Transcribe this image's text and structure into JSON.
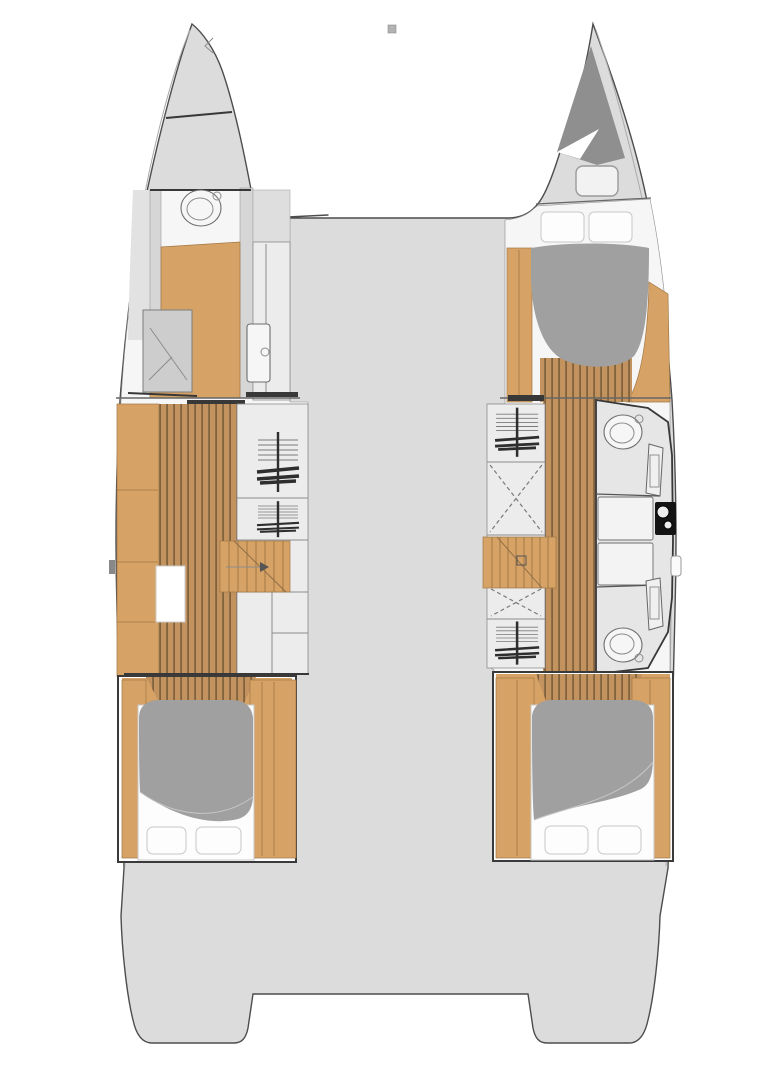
{
  "meta": {
    "diagram_type": "catamaran-floor-plan",
    "view": "top-down"
  },
  "colors": {
    "page_bg": "#ffffff",
    "deck": "#dcdcdc",
    "outline": "#4d4d4d",
    "interior": "#f6f6f6",
    "wall": "#d6d6d6",
    "cabinet": "#ececec",
    "wood": "#d7a265",
    "wood_edge": "#a07845",
    "plank_base": "#c2935f",
    "plank_line": "#82623d",
    "duvet": "#a0a0a0",
    "linen": "#fdfdfd",
    "linen_edge": "#c8c8c8",
    "bulkhead": "#383838",
    "thin_line": "#8c8c8c",
    "sheer_line": "#aaaaaa",
    "sail_gray": "#8f8f8f",
    "appliance": "#141414",
    "symbol": "#7a7a7a",
    "symbol_dark": "#2e2e2e",
    "fixture_fill": "#f6f6f6",
    "fixture_stroke": "#6e6e6e",
    "hatch_fill": "#f2f2f2",
    "hatch_stroke": "#9a9a9a",
    "counter": "#f3f3f3",
    "bath_floor": "#e6e6e6",
    "shower_fill": "#cdcdcd",
    "mast_marker": "#b3b3b3"
  },
  "symbols": {
    "toilet": "ellipse-bowl-icon",
    "shower": "hatched-square-icon",
    "wardrobe": "hanging-clothes-icon",
    "storage_option": "dashed-x-box-icon",
    "stairs": "stepped-wood-icon",
    "sink_unit": "black-basin-icon",
    "double_bed": "duvet-pillows-icon",
    "deck_hatch": "rounded-rect-icon",
    "mast_fitting": "small-square-icon"
  }
}
